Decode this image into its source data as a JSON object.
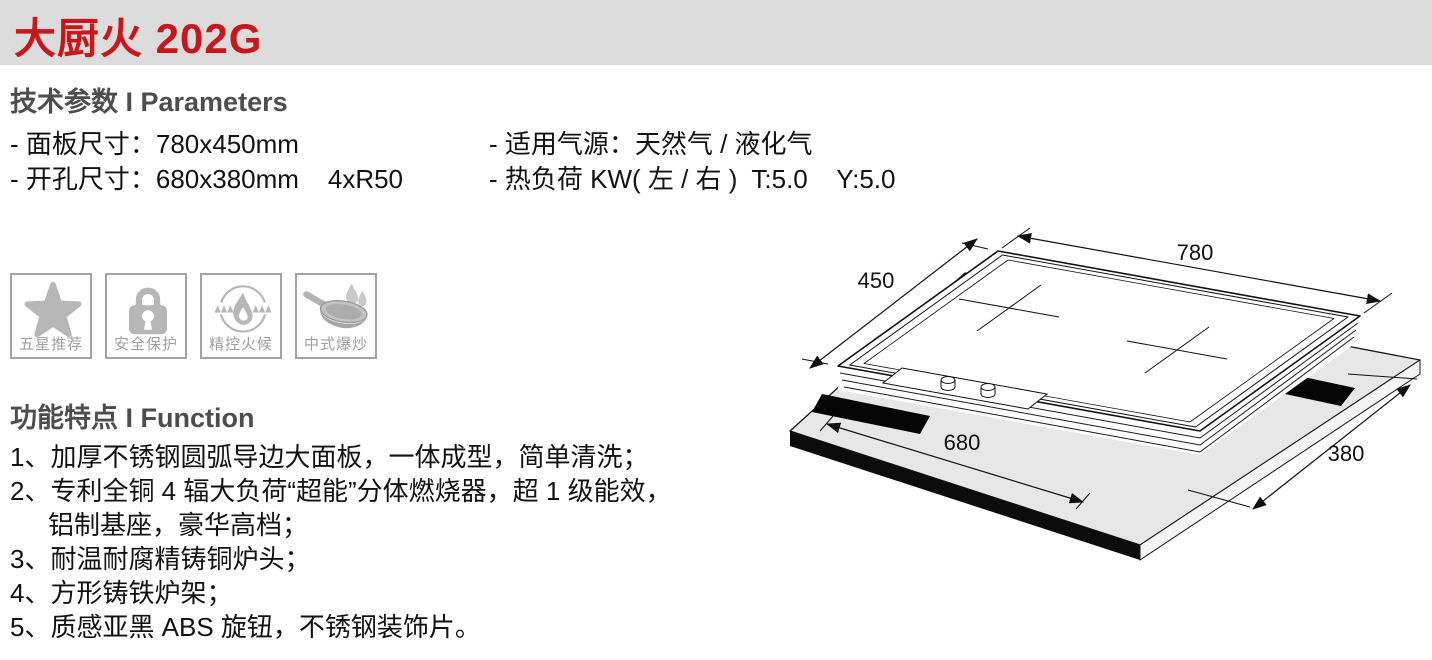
{
  "header": {
    "title": "大厨火 202G",
    "bar_color": "#dcdcdc",
    "accent_color": "#c9161c"
  },
  "parameters": {
    "heading": "技术参数 I Parameters",
    "left": [
      "- 面板尺寸：780x450mm",
      "- 开孔尺寸：680x380mm    4xR50"
    ],
    "right": [
      "- 适用气源：天然气 / 液化气",
      "- 热负荷 KW( 左 / 右 )  T:5.0    Y:5.0"
    ]
  },
  "features": [
    {
      "label": "五星推荐",
      "icon": "star-icon"
    },
    {
      "label": "安全保护",
      "icon": "lock-icon"
    },
    {
      "label": "精控火候",
      "icon": "flame-control-icon"
    },
    {
      "label": "中式爆炒",
      "icon": "wok-icon"
    }
  ],
  "functions": {
    "heading": "功能特点 I Function",
    "lines": [
      "1、加厚不锈钢圆弧导边大面板，一体成型，简单清洗；",
      "2、专利全铜 4 辐大负荷“超能”分体燃烧器，超 1 级能效，",
      "铝制基座，豪华高档；",
      "3、耐温耐腐精铸铜炉头；",
      "4、方形铸铁炉架；",
      "5、质感亚黑 ABS 旋钮，不锈钢装饰片。"
    ]
  },
  "diagram": {
    "description": "isometric drawing of cooktop over counter cutout",
    "dim_top": "780",
    "dim_left": "450",
    "dim_bottom": "680",
    "dim_right": "380",
    "icon_gray": "#b7b7b7"
  }
}
